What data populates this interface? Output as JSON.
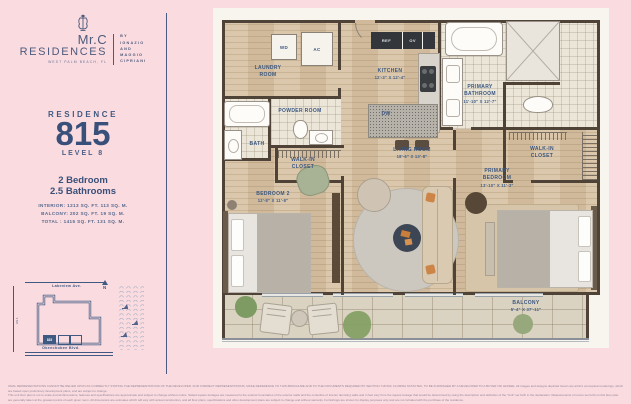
{
  "colors": {
    "accent_navy": "#3f5a82",
    "background_pink": "#fadbdf",
    "wall_dark": "#4f4338",
    "wood_floor": "#d7c2a3"
  },
  "brand": {
    "name": "Mr.C",
    "sub": "RESIDENCES",
    "location": "WEST PALM BEACH, FL",
    "by_lines": [
      "BY",
      "IGNAZIO",
      "AND",
      "MAGGIO",
      "CIPRIANI"
    ]
  },
  "residence": {
    "label": "RESIDENCE",
    "number": "815",
    "level": "LEVEL 8",
    "bedrooms": "2 Bedroom",
    "bathrooms": "2.5 Bathrooms"
  },
  "areas": {
    "interior": "INTERIOR: 1213 SQ. FT. 113 SQ. M.",
    "balcony": "BALCONY: 202 SQ. FT. 19 SQ. M.",
    "total": "TOTAL : 1415 SQ. FT. 131 SQ. M."
  },
  "keyplan": {
    "street_top": "Lakeview Ave.",
    "street_bottom": "Okeechobee Blvd.",
    "street_left": "US 1",
    "north_label": "N",
    "unit_marker": "815"
  },
  "floorplan": {
    "rooms": [
      {
        "name": "LAUNDRY ROOM",
        "dims": ""
      },
      {
        "name": "POWDER ROOM",
        "dims": ""
      },
      {
        "name": "BATH",
        "dims": ""
      },
      {
        "name": "WALK-IN CLOSET",
        "dims": ""
      },
      {
        "name": "BEDROOM 2",
        "dims": "12'-8\" x 11'-8\""
      },
      {
        "name": "KITCHEN",
        "dims": "12'-3\" x 12'-4\""
      },
      {
        "name": "LIVING ROOM",
        "dims": "18'-6\" x 13'-8\""
      },
      {
        "name": "PRIMARY BATHROOM",
        "dims": "11'-10\" x 12'-7\""
      },
      {
        "name": "PRIMARY BEDROOM",
        "dims": "13'-10\" x 11'-3\""
      },
      {
        "name": "WALK-IN CLOSET",
        "dims": ""
      },
      {
        "name": "BALCONY",
        "dims": "5'-4\" x 37'-11\""
      }
    ],
    "appliances": {
      "wd": "WD",
      "ac": "AC",
      "ref": "REF",
      "ov": "OV",
      "dw": "DW"
    }
  },
  "disclaimer": {
    "line1": "ORAL REPRESENTATIONS CANNOT BE RELIED UPON AS CORRECTLY STATING THE REPRESENTATIONS OF THE DEVELOPER. FOR CORRECT REPRESENTATIONS, MAKE REFERENCE TO THIS BROCHURE AND TO THE DOCUMENTS REQUIRED BY SECTION 718.503, FLORIDA STATUTES, TO BE FURNISHED BY A DEVELOPER TO A BUYER OR LESSEE. All images and designs depicted herein are artist's conceptual renderings, which are based upon preliminary development plans, and are subject to change.",
    "line2": "This unit floor plan is not to scale and all dimensions, features and specifications are approximate and subject to change without notice. Stated square footages are measured to the exterior boundaries of the exterior walls and the centerline of interior demising walls and in fact vary from the square footage that would be determined by using the description and definition of the \"Unit\" set forth in the declaration. Measurements of rooms set forth on this floor plan",
    "line3": "are generally taken at the greatest points of each given room. All dimensions are estimates which will vary with actual construction, and all floor plans, specifications and other development plans are subject to change and without warranty. Furnishings are shown for display purposes only and are not included with the purchase of the residence."
  }
}
